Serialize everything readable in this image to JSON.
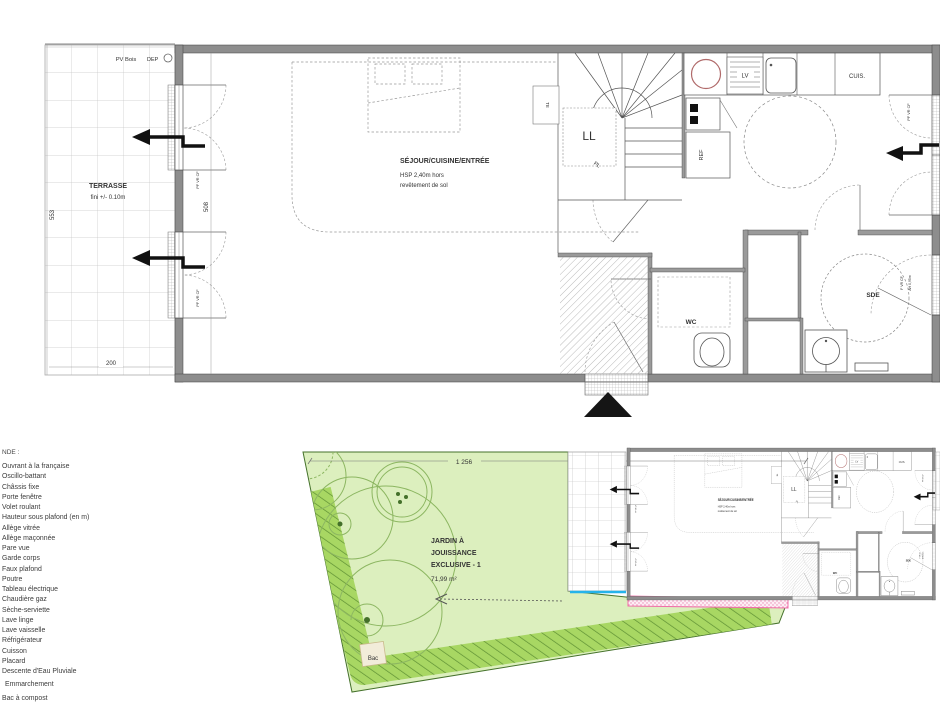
{
  "floor_plan": {
    "terrace": {
      "label": "TERRASSE",
      "note": "fini +/- 0.10m",
      "pv": "PV Bois",
      "dep": "DEP",
      "dim_height": "553",
      "dim_width": "200"
    },
    "rooms": {
      "sejour": "SÉJOUR/CUISINE/ENTRÉE",
      "hsp1": "HSP 2,40m hors",
      "hsp2": "revêtement de sol",
      "wc": "WC",
      "sde": "SDE"
    },
    "fixtures": {
      "ll": "LL",
      "pl": "PL",
      "te": "TE",
      "lv": "LV",
      "ref": "REF",
      "cuis": "CUIS."
    },
    "windows": {
      "pf": "PF VR CF",
      "f": "F VR CF",
      "ah": "AH 0,95m"
    },
    "dims": {
      "interior": "508"
    }
  },
  "garden": {
    "dim": "1 256",
    "label1": "JARDIN À",
    "label2": "JOUISSANCE",
    "label3": "EXCLUSIVE - 1",
    "area": "71,99 m²",
    "bac": "Bac"
  },
  "legend": {
    "title": "NDE :",
    "items": [
      "Ouvrant à la française",
      "Oscillo-battant",
      "Châssis fixe",
      "Porte fenêtre",
      "Volet roulant",
      "Hauteur sous plafond (en m)",
      "Allège vitrée",
      "Allège maçonnée",
      "Pare vue",
      "Garde corps",
      "Faux plafond",
      "Poutre",
      "Tableau électrique",
      "Chaudière gaz",
      "Sèche-serviette",
      "Lave linge",
      "Lave vaisselle",
      "Réfrigérateur",
      "Cuisson",
      "Placard",
      "Descente d'Eau Pluviale",
      "Emmarchement",
      "Bac à compost"
    ]
  }
}
